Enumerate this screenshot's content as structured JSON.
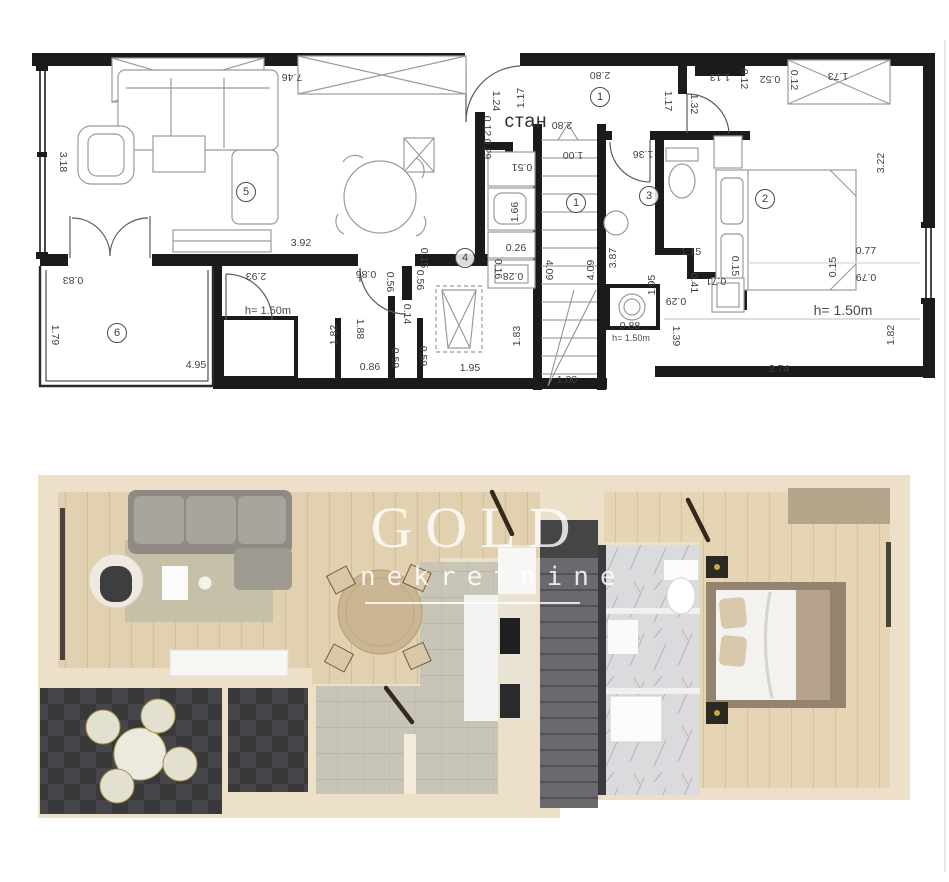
{
  "watermark": {
    "brand": "GOLD",
    "subtitle": "nekretnine"
  },
  "technical_plan": {
    "unit_label": {
      "text": "стан",
      "x": 526,
      "y": 122
    },
    "room_numbers": [
      {
        "n": "1",
        "x": 600,
        "y": 97
      },
      {
        "n": "1",
        "x": 576,
        "y": 203
      },
      {
        "n": "2",
        "x": 765,
        "y": 199
      },
      {
        "n": "3",
        "x": 649,
        "y": 196
      },
      {
        "n": "4",
        "x": 465,
        "y": 258
      },
      {
        "n": "5",
        "x": 246,
        "y": 192
      },
      {
        "n": "6",
        "x": 117,
        "y": 333
      }
    ],
    "dimensions": [
      {
        "t": "7.46",
        "x": 292,
        "y": 77,
        "r": 180
      },
      {
        "t": "2.80",
        "x": 600,
        "y": 75,
        "r": 180
      },
      {
        "t": "1.13",
        "x": 720,
        "y": 77,
        "r": 180
      },
      {
        "t": "0.12",
        "x": 744,
        "y": 79,
        "r": 90
      },
      {
        "t": "0.52",
        "x": 770,
        "y": 79,
        "r": 180
      },
      {
        "t": "0.12",
        "x": 794,
        "y": 80,
        "r": 90
      },
      {
        "t": "1.73",
        "x": 838,
        "y": 76,
        "r": 180
      },
      {
        "t": "3.18",
        "x": 63,
        "y": 162,
        "r": 90
      },
      {
        "t": "3.22",
        "x": 881,
        "y": 163,
        "r": 270
      },
      {
        "t": "1.24",
        "x": 496,
        "y": 101,
        "r": 90
      },
      {
        "t": "1.17",
        "x": 521,
        "y": 98,
        "r": 270
      },
      {
        "t": "1.17",
        "x": 668,
        "y": 101,
        "r": 90
      },
      {
        "t": "1.32",
        "x": 694,
        "y": 104,
        "r": 90
      },
      {
        "t": "0.12",
        "x": 487,
        "y": 126,
        "r": 90
      },
      {
        "t": "0.29",
        "x": 487,
        "y": 149,
        "r": 90
      },
      {
        "t": "0.51",
        "x": 522,
        "y": 167,
        "r": 180
      },
      {
        "t": "1.00",
        "x": 573,
        "y": 155,
        "r": 180
      },
      {
        "t": "1.36",
        "x": 643,
        "y": 154,
        "r": 180
      },
      {
        "t": "2.80",
        "x": 562,
        "y": 125,
        "r": 180
      },
      {
        "t": "1.66",
        "x": 515,
        "y": 212,
        "r": 270
      },
      {
        "t": "0.26",
        "x": 516,
        "y": 248,
        "r": 0
      },
      {
        "t": "0.16",
        "x": 498,
        "y": 269,
        "r": 90
      },
      {
        "t": "0.28",
        "x": 513,
        "y": 276,
        "r": 180
      },
      {
        "t": "4.09",
        "x": 549,
        "y": 270,
        "r": 90
      },
      {
        "t": "4.09",
        "x": 591,
        "y": 270,
        "r": 270
      },
      {
        "t": "3.87",
        "x": 613,
        "y": 258,
        "r": 270
      },
      {
        "t": "1.15",
        "x": 691,
        "y": 252,
        "r": 0
      },
      {
        "t": "1.95",
        "x": 652,
        "y": 285,
        "r": 270
      },
      {
        "t": "0.15",
        "x": 735,
        "y": 266,
        "r": 90
      },
      {
        "t": "0.15",
        "x": 833,
        "y": 267,
        "r": 270
      },
      {
        "t": "0.77",
        "x": 866,
        "y": 251,
        "r": 0
      },
      {
        "t": "0.79",
        "x": 866,
        "y": 277,
        "r": 180
      },
      {
        "t": "0.41",
        "x": 694,
        "y": 283,
        "r": 90
      },
      {
        "t": "0.71",
        "x": 716,
        "y": 281,
        "r": 180
      },
      {
        "t": "0.29",
        "x": 676,
        "y": 301,
        "r": 180
      },
      {
        "t": "1.39",
        "x": 676,
        "y": 336,
        "r": 90
      },
      {
        "t": "0.88",
        "x": 630,
        "y": 326,
        "r": 0
      },
      {
        "t": "3.74",
        "x": 779,
        "y": 369,
        "r": 0
      },
      {
        "t": "1.82",
        "x": 891,
        "y": 335,
        "r": 270
      },
      {
        "t": "0.83",
        "x": 73,
        "y": 280,
        "r": 180
      },
      {
        "t": "1.79",
        "x": 55,
        "y": 335,
        "r": 90
      },
      {
        "t": "4.95",
        "x": 196,
        "y": 365,
        "r": 0
      },
      {
        "t": "2.93",
        "x": 256,
        "y": 276,
        "r": 180
      },
      {
        "t": "1.82",
        "x": 334,
        "y": 335,
        "r": 270
      },
      {
        "t": "1.88",
        "x": 360,
        "y": 329,
        "r": 90
      },
      {
        "t": "0.86",
        "x": 366,
        "y": 274,
        "r": 180
      },
      {
        "t": "0.56",
        "x": 390,
        "y": 282,
        "r": 90
      },
      {
        "t": "0.56",
        "x": 420,
        "y": 280,
        "r": 90
      },
      {
        "t": "0.15",
        "x": 424,
        "y": 258,
        "r": 90
      },
      {
        "t": "0.14",
        "x": 407,
        "y": 314,
        "r": 90
      },
      {
        "t": "0.86",
        "x": 370,
        "y": 367,
        "r": 0
      },
      {
        "t": "0.59",
        "x": 395,
        "y": 358,
        "r": 90
      },
      {
        "t": "0.59",
        "x": 423,
        "y": 356,
        "r": 90
      },
      {
        "t": "1.95",
        "x": 470,
        "y": 368,
        "r": 0
      },
      {
        "t": "1.83",
        "x": 517,
        "y": 336,
        "r": 270
      },
      {
        "t": "1.00",
        "x": 567,
        "y": 380,
        "r": 0
      },
      {
        "t": "3.92",
        "x": 301,
        "y": 243,
        "r": 0
      }
    ],
    "height_notes": [
      {
        "t": "h= 1.50m",
        "x": 268,
        "y": 311,
        "s": 11
      },
      {
        "t": "h= 1.50m",
        "x": 631,
        "y": 338,
        "s": 9
      },
      {
        "t": "h= 1.50m",
        "x": 843,
        "y": 310,
        "s": 14
      }
    ]
  },
  "rendered_plan": {
    "colors": {
      "wall_beige": "#ece0c8",
      "wood_floor": "#e1d1b0",
      "gray_tile": "#c9c5b6",
      "dark_tile": "#3a3a3c",
      "stairs": "#69696e",
      "marble": "#dbdbde",
      "sofa": "#a5a098",
      "rug": "#c7c0a9",
      "bed_blanket": "#b5a48b",
      "door_line": "#33291d"
    }
  }
}
